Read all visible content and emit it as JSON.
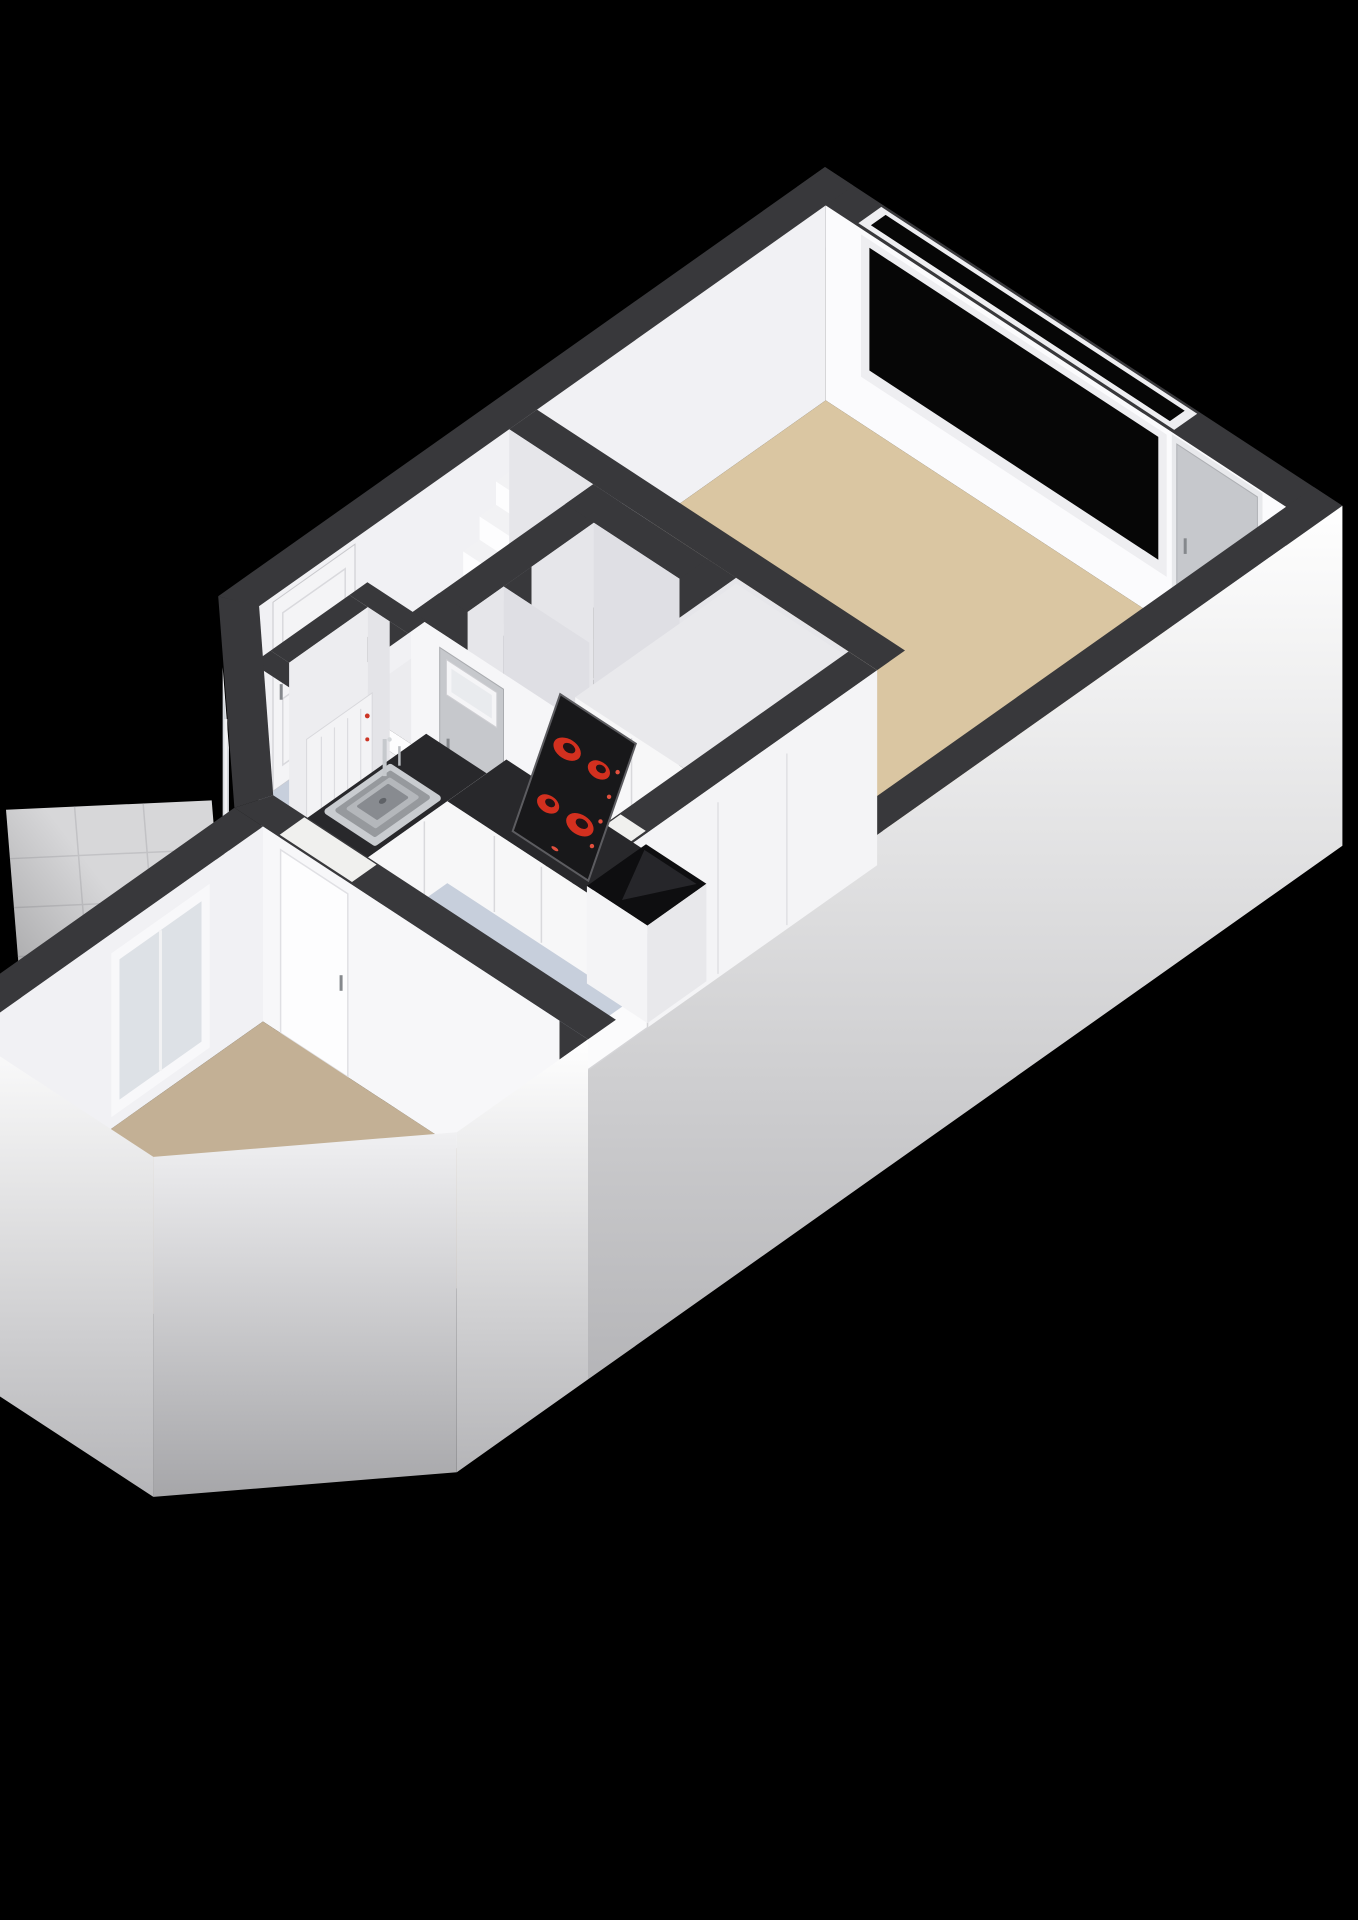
{
  "scene": {
    "kind": "isometric-3d-floor-plan",
    "background": "#000000"
  },
  "colors": {
    "background": "#000000",
    "wall_top": "#38383b",
    "wall_top_dark": "#2e2e31",
    "face_white": "#fbfbfd",
    "face_light": "#f1f1f4",
    "face_shade": "#e6e6ea",
    "face_dim": "#dadade",
    "closet_face": "#dfdfe4",
    "floor_living": "#dac6a2",
    "floor_kitchen": "#c7cfdc",
    "floor_room": "#c3b095",
    "floor_closet": "#e8e8ec",
    "floor_niche": "#a9adb3",
    "patio": "#d7d7d9",
    "patio_line": "#c2c2c5",
    "glass_black": "#060606",
    "glass_light": "#ccd1d7",
    "door_gray": "#c6c8cc",
    "door_white": "#f4f4f6",
    "frame_white": "#eeeef1",
    "counter_top": "#28282b",
    "cabinet_front": "#f7f7f8",
    "cabinet_seam": "#d9d9dc",
    "unit_top": "#0e0e10",
    "stove_panel": "#18181a",
    "burner_red": "#d3301f",
    "burner_dark": "#201416",
    "knob_red": "#e2503e",
    "steel_rim": "#c9ccd0",
    "steel_mid": "#96999d",
    "steel_in": "#b4b7bb",
    "basin": "#888b90",
    "stair_top": "#f2f2f4",
    "stair_riser": "#fdfdfe",
    "radiator": "#f3f3f5",
    "radiator_dot": "#cc3525",
    "threshold": "#f0f0ee",
    "handle": "#85888c",
    "ext_top": "#ffffff",
    "ext_bottom": "#b5b5b8"
  },
  "rooms": [
    {
      "id": "living-room",
      "floor_color": "#dac6a2",
      "features": [
        "large-black-window",
        "gray-entry-door"
      ]
    },
    {
      "id": "kitchen",
      "floor_color": "#c7cfdc",
      "features": [
        "sink",
        "faucet",
        "cooktop-4-burners",
        "counter",
        "tall-cabinets",
        "black-unit",
        "window"
      ]
    },
    {
      "id": "hallway",
      "features": [
        "entry-door",
        "radiator-niche"
      ]
    },
    {
      "id": "staircase",
      "features": [
        "winder-stairs",
        "door-with-transom"
      ]
    },
    {
      "id": "closet-1",
      "floor_color": "#e8e8ec",
      "features": []
    },
    {
      "id": "closet-2",
      "floor_color": "#e8e8ec",
      "features": []
    },
    {
      "id": "lower-room",
      "floor_color": "#c3b095",
      "features": [
        "white-door",
        "tall-window"
      ]
    },
    {
      "id": "patio",
      "floor_color": "#d7d7d9",
      "features": [
        "tiles"
      ]
    }
  ]
}
